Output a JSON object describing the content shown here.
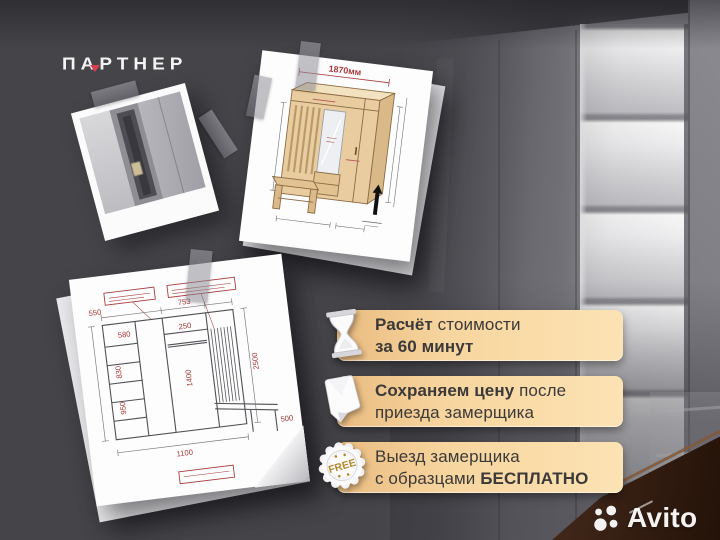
{
  "brand": {
    "name": "ПАРТНЕР",
    "accent_color": "#d6404e"
  },
  "banners": [
    {
      "icon": "hourglass-icon",
      "line1": [
        "Расчёт ",
        "стоимости"
      ],
      "line2": [
        "за 60 минут"
      ]
    },
    {
      "icon": "price-paper-icon",
      "line1": [
        "Сохраняем цену",
        " после"
      ],
      "line2": [
        "приезда замерщика"
      ]
    },
    {
      "icon": "free-badge-icon",
      "badge_text": "FREE",
      "line1": [
        "Выезд замерщика"
      ],
      "line2": [
        "с образцами ",
        "БЕСПЛАТНО"
      ]
    }
  ],
  "drawings": {
    "perspective": {
      "width_label": "1870мм"
    },
    "elevation": {
      "dims": [
        "550",
        "753",
        "580",
        "250",
        "830",
        "1400",
        "950",
        "2500",
        "1100",
        "500"
      ]
    }
  },
  "watermark": {
    "brand": "Avito"
  },
  "colors": {
    "background": "#454449",
    "banner_gradient_start": "#e9bb80",
    "banner_gradient_end": "#fce3b4",
    "banner_text": "#3b3939",
    "free_gold": "#b8872b",
    "drawing_red": "#a93939",
    "wood_tan": "#e9cda0"
  }
}
